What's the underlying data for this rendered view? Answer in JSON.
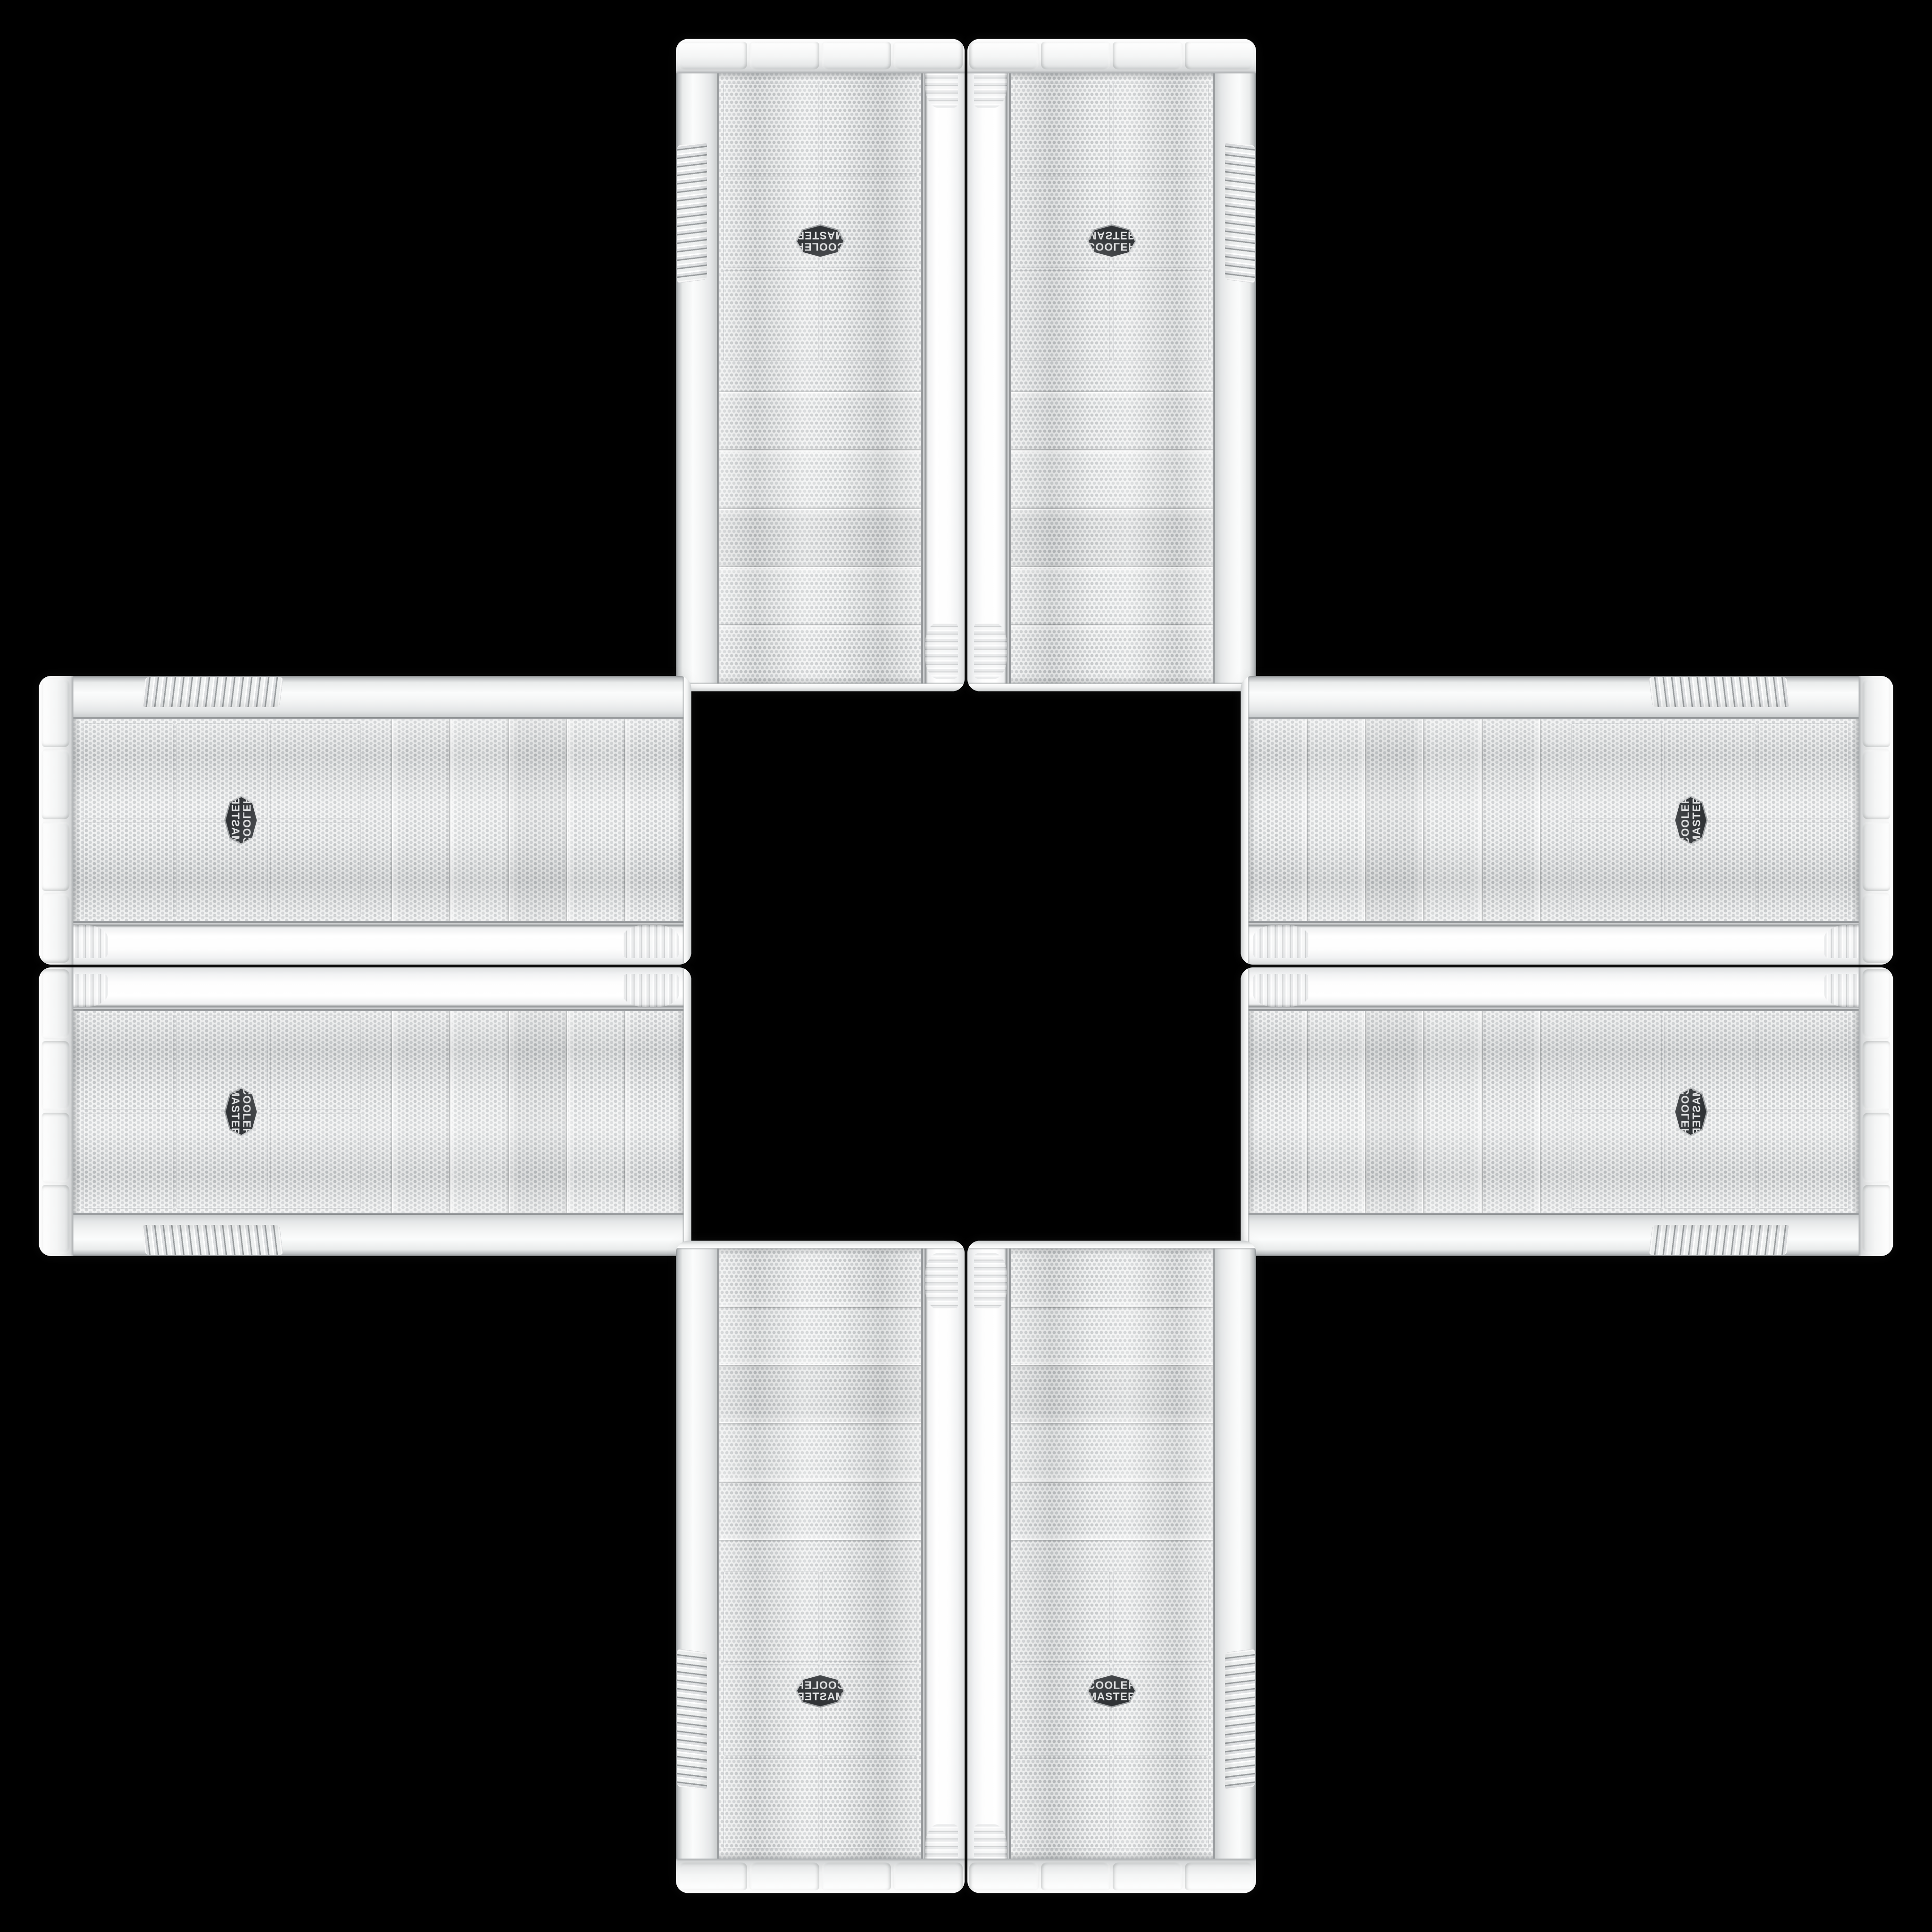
{
  "badge": {
    "line1": "COOLER",
    "line2": "MASTER"
  },
  "colors": {
    "bg": "#000000",
    "mesh-base": "#eff0f0",
    "mesh-dot": "#bfc2c4",
    "mesh-dot2": "#cbced0",
    "seam": "#9a9da0",
    "badge-bg": "#303336",
    "badge-metal": "#e6e7e8",
    "badge-text": "#e0e1e2"
  }
}
